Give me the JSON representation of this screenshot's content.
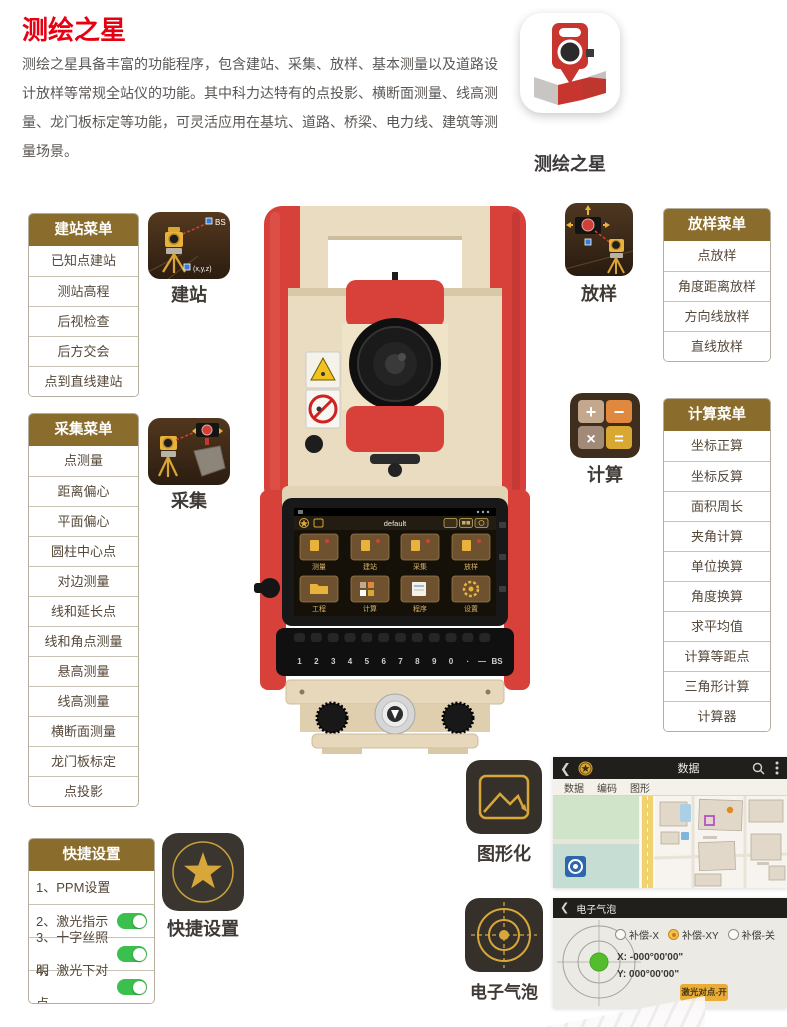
{
  "page": {
    "title": "测绘之星",
    "description": "测绘之星具备丰富的功能程序，包含建站、采集、放样、基本测量以及道路设计放样等常规全站仪的功能。其中科力达特有的点投影、横断面测量、线高测量、龙门板标定等功能，可灵活应用在基坑、道路、桥梁、电力线、建筑等测量场景。"
  },
  "app_icon": {
    "label": "测绘之星"
  },
  "menus": {
    "station": {
      "title": "建站菜单",
      "items": [
        "已知点建站",
        "测站高程",
        "后视检查",
        "后方交会",
        "点到直线建站"
      ]
    },
    "collect": {
      "title": "采集菜单",
      "items": [
        "点测量",
        "距离偏心",
        "平面偏心",
        "圆柱中心点",
        "对边测量",
        "线和延长点",
        "线和角点测量",
        "悬高测量",
        "线高测量",
        "横断面测量",
        "龙门板标定",
        "点投影"
      ]
    },
    "stakeout": {
      "title": "放样菜单",
      "items": [
        "点放样",
        "角度距离放样",
        "方向线放样",
        "直线放样"
      ]
    },
    "calc": {
      "title": "计算菜单",
      "items": [
        "坐标正算",
        "坐标反算",
        "面积周长",
        "夹角计算",
        "单位换算",
        "角度换算",
        "求平均值",
        "计算等距点",
        "三角形计算",
        "计算器"
      ]
    },
    "quick": {
      "title": "快捷设置",
      "items": [
        {
          "label": "1、PPM设置",
          "toggle": false
        },
        {
          "label": "2、激光指示",
          "toggle": true
        },
        {
          "label": "3、十字丝照明",
          "toggle": true
        },
        {
          "label": "4、激光下对点",
          "toggle": true
        }
      ]
    }
  },
  "feature_icons": {
    "station": {
      "label": "建站",
      "bs": "BS",
      "xyz": "(x,y,z)"
    },
    "stakeout": {
      "label": "放样"
    },
    "collect": {
      "label": "采集"
    },
    "calc": {
      "label": "计算",
      "glyphs": [
        "+",
        "−",
        "×",
        "="
      ]
    },
    "graphic": {
      "label": "图形化"
    },
    "bubble": {
      "label": "电子气泡"
    },
    "quick": {
      "label": "快捷设置"
    }
  },
  "device_screen": {
    "title": "default",
    "apps": [
      "测量",
      "建站",
      "采集",
      "放样",
      "工程",
      "计算",
      "程序",
      "设置"
    ],
    "keys": [
      "1",
      "2",
      "3",
      "4",
      "5",
      "6",
      "7",
      "8",
      "9",
      "0",
      "·",
      "—",
      "BS"
    ]
  },
  "data_screenshot": {
    "title": "数据",
    "tabs": [
      "数据",
      "编码",
      "图形"
    ]
  },
  "bubble_screenshot": {
    "title": "电子气泡",
    "radios": [
      {
        "label": "补偿-X",
        "selected": false
      },
      {
        "label": "补偿-XY",
        "selected": true
      },
      {
        "label": "补偿-关",
        "selected": false
      }
    ],
    "x_value": "X: -000°00'00\"",
    "y_value": "Y: 000°00'00\"",
    "button": "激光对点-开"
  },
  "colors": {
    "accent_red": "#e60012",
    "menu_header_gold": "#8a6c2c",
    "toggle_green": "#3bbf4e",
    "icon_gold": "#d8a73a",
    "instrument_red": "#d8403a",
    "instrument_beige": "#e9dcc0"
  }
}
